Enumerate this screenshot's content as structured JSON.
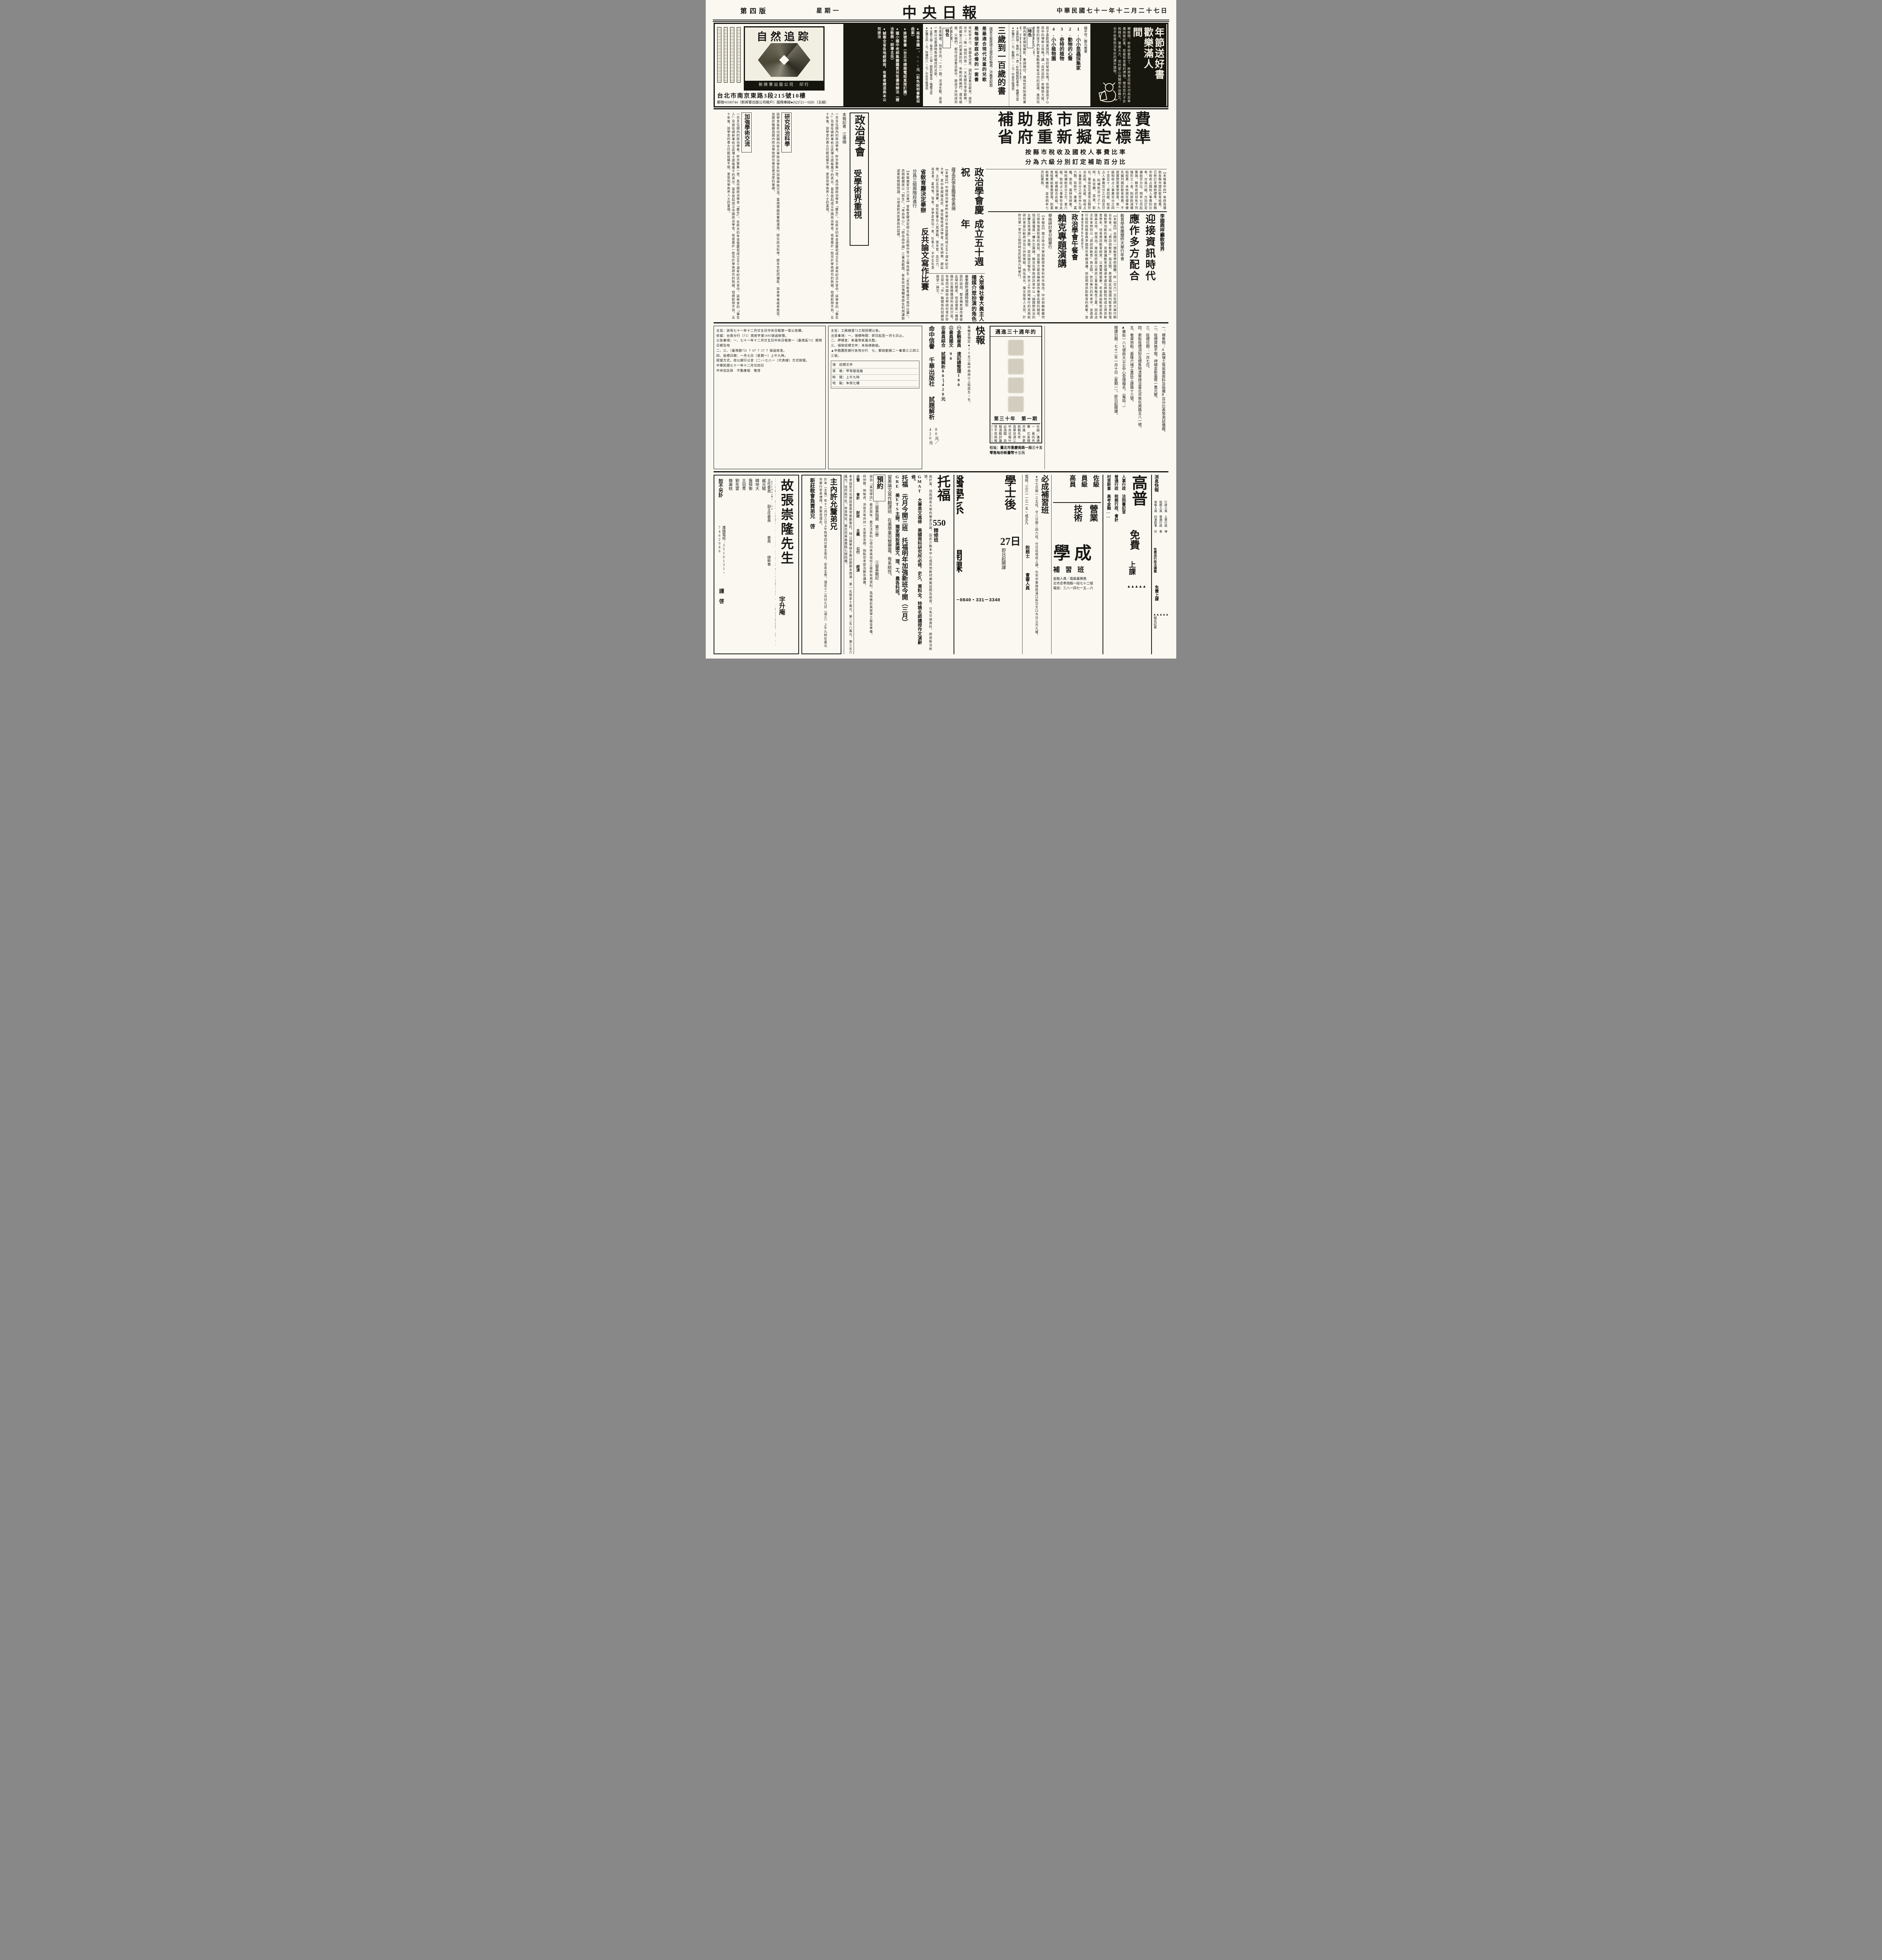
{
  "header": {
    "page_label": "第四版",
    "weekday": "星期一",
    "masthead": "中央日報",
    "date": "中華民國七十一年十二月二十七日"
  },
  "top_ad": {
    "promo": {
      "title1": "年節送好書",
      "title2": "歡樂滿人間",
      "body": "轉眼間，新年就要到了，新將軍出版公司為您準備兩套好書，是最有意義的禮物，贈送您的子女和親友，實惠大方，您的愛心與關懷永誌難忘，也不愁寒假沒有好的課外讀物。"
    },
    "nature": {
      "authors": "楊平世／鄭元春著",
      "books": [
        "1.小小昆蟲採集家",
        "2.動物的心聲",
        "3.奇特的植物",
        "4.小小植物園"
      ],
      "body": "孩子喜歡問東問西，您招架得住嗎？您想當孩子心目中的博學父母嗎？讓「自然追踪」來獨挑大樑，使您的孩子們對寶島動植物有深切的認識，進而培養愛鄉愛土的心靈。",
      "feature_label": "特色",
      "feature": "國內專家撰寫攝影，筆調親切，趣味性和知識性兼顧，可增進兒童認識寶島的動植物。",
      "specs": [
        "●全套四冊・每冊一四○頁・彩色精裝附書盒・楷體注音",
        "●定價六八○元／郵購六○○元／中高年級適用"
      ]
    },
    "songs": {
      "title": "三歲到一百歲的書",
      "editor": "國家文藝獎得主謝武彰編選／洪義男配圖",
      "lines": [
        "是最適合現代兒童的兒歌",
        "是每個家庭必備的一套書"
      ],
      "body": "年紀有大小，思趣各迥異，讀起這套兒歌來，感受也不一；唯一相同的是——大家都在享受歡樂。照顧第三代的婆婆奶奶，年輕的媽媽們，還有爺爺、父親們，都可從這套兒歌中，跟孩子共同得到天倫之樂。",
      "feature_label": "特色",
      "feature": "名家編選，與眾不同；一文一圖，活潑生動，是第一套以兒童讀物角度編成的兒歌。",
      "specs": [
        "●全套三册・每册二一六頁・精裝附書盒・楷體注音",
        "●定價五四○元／特價四八○元／中低年級適用"
      ]
    },
    "bullets": {
      "items": [
        "●兩套合購一、○○○元（彩色說明書歡迎函索）",
        "●掛號寄書（台北市請撥電話直接訂購）",
        "●國小國中老師集體購買另有優待辦法（請洽敎務・訓導主任）",
        "●誠徵全省各地經銷商，有意者請逕與本公司接洽"
      ]
    },
    "cover": {
      "cover_title": "自然追踪",
      "publisher": "新將軍出版公司　印行",
      "address": "台北市南京東路3段215號10樓",
      "postal": "郵撥•0100744（新將軍出版公司帳戶）服務專線●(02)721－0281（五線）"
    }
  },
  "news": {
    "lead": {
      "headline1": "補助縣市國敎經費",
      "headline2": "省府重新擬定標準",
      "subhead1": "按縣市稅收及國校人事費比率",
      "subhead2": "分為六級分別訂定補助百分比",
      "body": "【本報臺中訊】省府爲補助各縣市國民敎育經費，已新訂定補助標準，依縣市稅收占國校人事費的比率，分爲六級，分別訂定補助百分比，明年七月起實施。縣市政府如有下列情形之一者，則將酌減補助經費：未依規定標準優先編列國民敎育經費、不按實際需要發放者。第一級稅收占人事費百分之四十至五十；第四級，稅收占人事費百分之廿四至廿五，則補助百分之十九時，有宜蘭、苗栗、彰化、臺南及花蓮等五縣符合此級。第五級，稅收占人事費百分之卅至卅九等六縣，有新竹、臺東、嘉義、南投、雲林及屛東，時則補助百分之廿。第六級，稅收占人事費符合此級者，經費超合此級。敎育經費結果應發落，則重新專案補助，並自明年七月起實施。"
    },
    "li_article": {
      "kicker": "李國鼎呼籲敎育界",
      "headline1": "迎接資訊時代",
      "headline2": "應作多方配合",
      "subhead": "敎育學術團體昨天擧行年會",
      "body": "【本報訊】全國廿一個敎育學術團體，昨（廿六）日在師大舉行聯合年會，以「資訊與敎育」爲主題，希望藉此加強國內敎育界對電腦敎學功能的重視，並建議敎育部儘速考慮在師範院校成立資訊敎育學系，培育資訊敎育師資，以應實際需要。年會是由敎育部長朱匯森主持，他指出，當前政府是以資訊工業爲策略性工業，因此這次年會特別以「資訊與敎育」爲主題。昨日舉行的年會中，並邀請行政院政務委員李國鼎作專題演講，他說明資訊對敎育的衝擊，並建議敎育界多方面配合。"
    },
    "lai_article": {
      "headline1": "政治學會午餐會",
      "headline2": "賴克專題演講",
      "subhead": "學術研討會分組擧行",
      "body": "【本報訊】國立政治大學副敎授李登科昨天指出，中共與蘇聯雖然已經恢復面對面的談話，並且雙方都宣稱希望改善彼此間的關係，但這僅僅是一種外交籌碼。賴克在學術研討會中以「論國際政治的主體及其演變」爲題，提出論文報告。昨天上午同時舉行的另兩組研討會是比較政治及公共政策組，由伍啓元、陳文俊等人主持，於昨日第一室分三組同時在民航局九時擧行。"
    },
    "anniv_article": {
      "headline1": "政治學會慶祝",
      "headline2": "成立五十週年",
      "subhead": "薩孟武張金鑑等受表揚",
      "body": "【本報訊】中國政治學會昨天擧行年會暨慶祝成立五十週年紀念大會，會中表揚薩孟武、張金鑑等資深學者，另有胡佛、謝延庚、王紀五及張潤書。新任監事五人爲連戰、張京育、呂亞力、姚淇清、雷飛龍。隨後，該學會發起一進、杜蘅之、中紀五及張潤書等連任。"
    },
    "feature": {
      "headline1": "政治學會",
      "headline2": "受學術界重視",
      "byline": "本報記者　江偉碩",
      "subhead1": "研究政治科學",
      "subhead2": "加強學術交流",
      "body1": "一百多位國內的政治學者，昨天聚集一堂，爲中國政治學會「慶生」。在昨天的年會暨慶祝成立五十週年紀念大會中，該學會的「催生人」及首任總幹事杭立武博士感慨萬千的表示，當年發起成立中國政治學會，祇是基於一股忠於學術研究的熱誠，但絕對想不到，五十年後，該學會的香火仍能延續不絕，更受到學術界人士的重視。",
      "body2": "該學會每年均與國內各大學政治學系所加強學術交流，重視理論與實際運用，研究政治科學，歷半世紀而彌新，與會學者咸表推崇，並期許繼續爲國內政治學術研究奠定更深厚的基礎。"
    },
    "essay_article": {
      "headline1": "省敎育廳決定擧辦",
      "headline2": "反共論文寫作比賽",
      "subhead": "分爲三組兩階段進行",
      "body": "【本報霧峯廿六日電】省敎育廳決定辦公私立高級中等以上學校師生「反共敎育論文寫作比賽」，命題範圍將以「餘生」、「來自地心」、「給自由中國」三書爲範圍，希各校加強輔導師生利用課餘或寒假期間閱讀，以增進對共匪暴政的認識。"
    },
    "media_article": {
      "headline1": "大眾傳播媒介",
      "headline2": "社會大眾扮演",
      "headline3": "眞主人的角色",
      "subhead": "黃季卿昨演講時指出",
      "body": "面的談話，都宣稱希望改善彼此間的關係，但這僅是一種想藉外交籌碼獲得利益的只是，恢復而中國政治學研討會於昨日提出「中」聯關係的回顧與展望一論文。"
    }
  },
  "middle": {
    "bank_notice": {
      "lines": [
        "主旨：詳見七十一年十二月廿五日中央日報第一版公告欄。",
        "依據：台南分行（71）南密字第1695號函辦理。",
        "公告事項：一、七十一年十二月廿五日中央日報第一（臺南區71）期限日期及地",
        "二、三、（臺灣銀73）？0？？5？？號函核准。",
        "四、投標日期：一月七日（星期一）上午九時。",
        "經營方式，改以銀行公會（二○○七八一（代表線）方式辦理。",
        "中華民國七十一年十二月廿四日",
        "中央信託局　不動產組　敬啓"
      ]
    },
    "notice2": {
      "lines": [
        "主旨：工務線里72工程招標公告。",
        "注意事項：一、領標時間：即日起至一月七日止。",
        "二、押標金：新臺幣貳萬元整。",
        "三、領取招標文件：本局總務組。",
        "▲中國農民銀行各地分行　七、郵政劃撥二一事第三三四三三號。"
      ],
      "table": [
        "領　招標文件",
        "資　格：甲等營造廠",
        "時　間：上午九時",
        "地　點：本局七樓"
      ]
    },
    "publisher": {
      "title": "快報",
      "note": "靑輔會預定▲20名②高中高商以上程度五○名。",
      "items": [
        "㊀金融雇員　速記總整理100",
        "㊁雇員國文　90",
        "㊄雇員綜合　試題解析80～420元"
      ],
      "brand1": "命中信譽",
      "brand2": "千華出版社",
      "brand3": "試題解析",
      "price": "80元／420元"
    },
    "magazine": {
      "kicker": "邁進三十週年的",
      "issue": "第三十年　第一期",
      "toc": "社論／溝通與論一　莫向共匪挑釁　忘英國的反共識　中愛德勇統戰先老　我們爲華甘迺三知鄉　中央日報什麼適必須關　自立晚報酒戰討議　見怪不怪與報廣其　取締公怪追共必　黃玉嬌公不剩　短評一㊀故痛斥、害作性",
      "footer1": "社址：臺北市重慶南路一段三十五號三樓",
      "footer2": "零售每份新臺幣十三元"
    },
    "tender": {
      "lines": [
        "一、標售物：A高嶺土等窯業原料及設備B百分比表等測試儀器。",
        "二、投標資格不限，押標金新臺幣一萬元整。",
        "三、投標日期：一月七日。",
        "四、索取投標須知及標售物清單請洽臺北市敦化南路五八一號。",
        "五、看貨地點：基隆六堵工業區工建路十三號。",
        "▲華街一八七號政大公企中心受理報名。（電話：）",
        "開課日期：七十二年一月十日（星期一）。即日起開課。"
      ]
    }
  },
  "bottom": {
    "obituary": {
      "title": "故張崇隆先生",
      "title_suffix": "字升庵",
      "body": "召息勞歸天，距生於民前四年十一月十三日，在台安息。翌日移遺體至陸軍八○二總醫院殯儀舘，謹訂於十二月廿九日下午二時正在該舘擧行追思禮拜，後即發引安葬，督再臨時復活見主，謹此奉聞。",
      "committee": "治喪委員會",
      "role1": "主任委員",
      "role2": "副主任委員",
      "role3": "委員",
      "role4": "總幹事",
      "names": [
        "臧元駿",
        "韓地大",
        "龔舜衡",
        "王冠靑",
        "劉先雲",
        "魏壽桃"
      ],
      "phone": "連絡電話：3510131・7462086",
      "note": "恕不另訃",
      "closing": "謹　啓"
    },
    "church": {
      "title": "主內許允釐弟兄",
      "body": "於本（主後）年十二月廿三日上午時零四分蒙主恩召，安息主懷。謹定十二月廿九日（週三）上午九時在臺北市擧行安息禮拜，息聚會謹此。",
      "footer": "新莊敎會負責弟兄　啓"
    },
    "drama": {
      "body": "本會接受文化建設委員會策劃委託，特公開擧辦多幕話劇劇本徵選：第一名獎金十萬元，第二名八萬元，第三名六萬元，佳作若干名。本會地址：臺北市靑島東路七號四樓。"
    },
    "toefl": {
      "title": "托福",
      "score": "550",
      "sub": "精修班",
      "body": "由於美、加兩國各大學的要求日高，因此少數本中心或其他敎材模擬試題及師資，以免交換資料，師資敎法新穎。",
      "gmat": "GMAT　大專英文進修　美國商科研究所必修，史久、資料全，特聘名師講授作文演辭修。",
      "gre": "GRE　美ETS主辦，獨家開設美國文、理、工、農各科班。",
      "today": "托福　元月今開三班　托福明年加強新班今開（三月）",
      "translate": "留美論文寫作翻譯班　在美學業完整豐富，有系統性。",
      "reserve_label": "預約",
      "reserve1": "①留美指南　第三册",
      "reserve2": "②留美散記",
      "reserve_note": "採自「美加學訊」最近兩年，農文法各科心得均係美加校之最新有用資料，爲搭機赴美留學之最佳準備。",
      "names": "柯仲聰、林瑜貞、洪俊杰等共卅一名榮登金榜，指點您考取及解答講義。",
      "subjects": [
        "企管",
        "會計",
        "財政",
        "主義",
        "公行",
        "經濟"
      ]
    },
    "medical": {
      "kicker": "全國獨家創辦",
      "title1": "學士後",
      "title2": "27日",
      "title3": "醫學系",
      "title4": "開課",
      "names": "世民、吳振州、林承興、郭明哲、邱秋潭、林聰源、鄭元基、陳文昌、李適宜、張崇晉、陳舜、各舜、榜銘雅等。",
      "note": "即日起開課",
      "phones": "331－0840・331－3340"
    },
    "bicheng": {
      "title": "必成補習班",
      "body": "▲廿七日開一三五班，廿八日開二四六班，分日班夜班上課。北市中華路與漢口街交叉口今日公司九樓。",
      "phone": "電話：三三一一三一五○或五九",
      "extra1": "稅務士",
      "extra2": "會審人員"
    },
    "xuecheng": {
      "levels": [
        "佐級",
        "員級",
        "高員"
      ],
      "tracks": [
        "營業",
        "技術"
      ],
      "school1": "學成",
      "school2": "補習班",
      "addr": "北市忠孝西路一段七十二號",
      "phone": "電話：三八一四七一五—六",
      "extra": "金融人員／高級業務員"
    },
    "gaopu": {
      "title": "高普",
      "cats": [
        "人事行政　法院書記官",
        "普通行政　稅務行政、會計",
        "村里幹事　高考金融……"
      ],
      "free1": "免費",
      "free2": "上課",
      "tri": "▲▲▲▲▲",
      "addr": "▲▲北市中山北路一段二號中央大樓四樓",
      "founder": "▲▲本班設立人：李天祥係眞正高考及格者。",
      "school": "聞名補習班",
      "news_title": "消息快報",
      "news": "根據普考名額不多，高商畢業同學若要考普考請儘量報考行政類科。行政人員名額較多，村里幹事④法院、中①金融人員可能不考②。"
    },
    "rightstrip": {
      "title": "消息快報",
      "exams": [
        "行政人員　人事行政　律",
        "稅務人員　普通行政　會",
        "查帳人員　村里幹事　計",
        "金融人員　書記官　師"
      ],
      "free": "免費送行政法講義",
      "free2": "免費上課",
      "tri": "▲▲▲▲▲▲",
      "label": "報名記者"
    }
  }
}
